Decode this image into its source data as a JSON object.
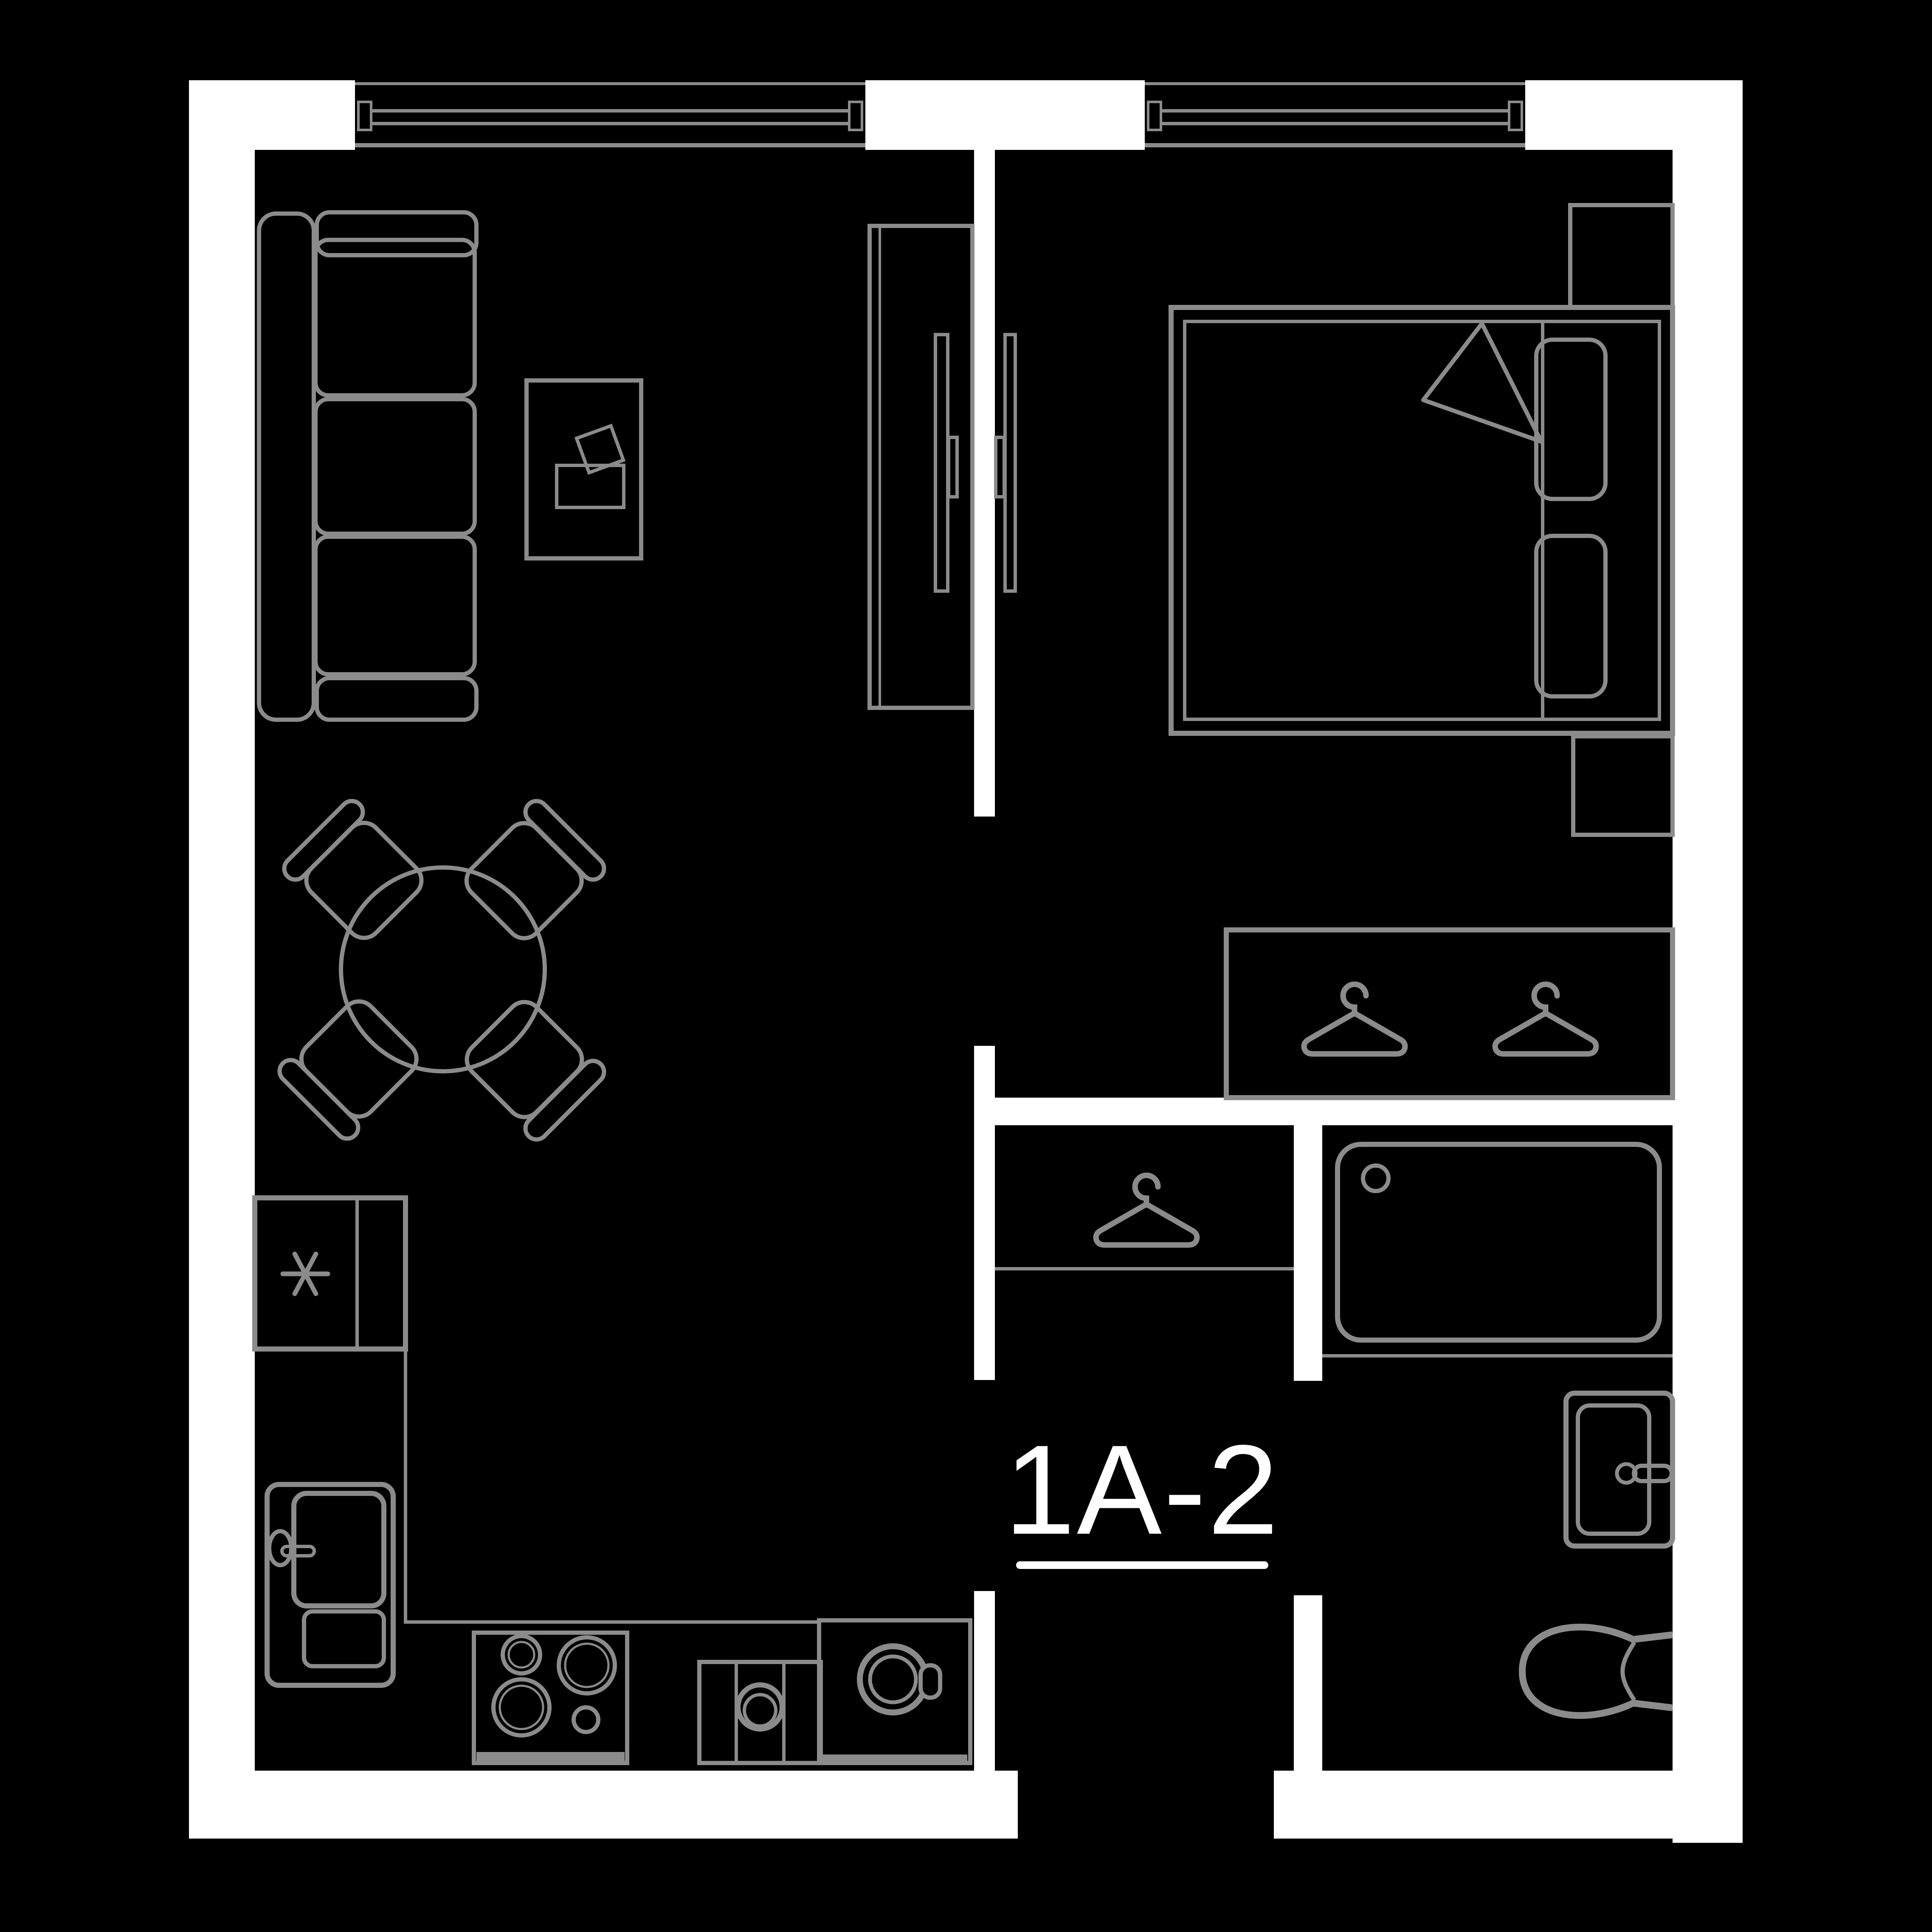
{
  "unit_label": {
    "text": "1A-2"
  },
  "colors": {
    "background": "#000000",
    "wall": "#ffffff",
    "furniture_line": "#8b8b8b",
    "label": "#ffffff"
  },
  "icons": {
    "hanger_count": 3,
    "freezer_symbol": "asterisk"
  }
}
